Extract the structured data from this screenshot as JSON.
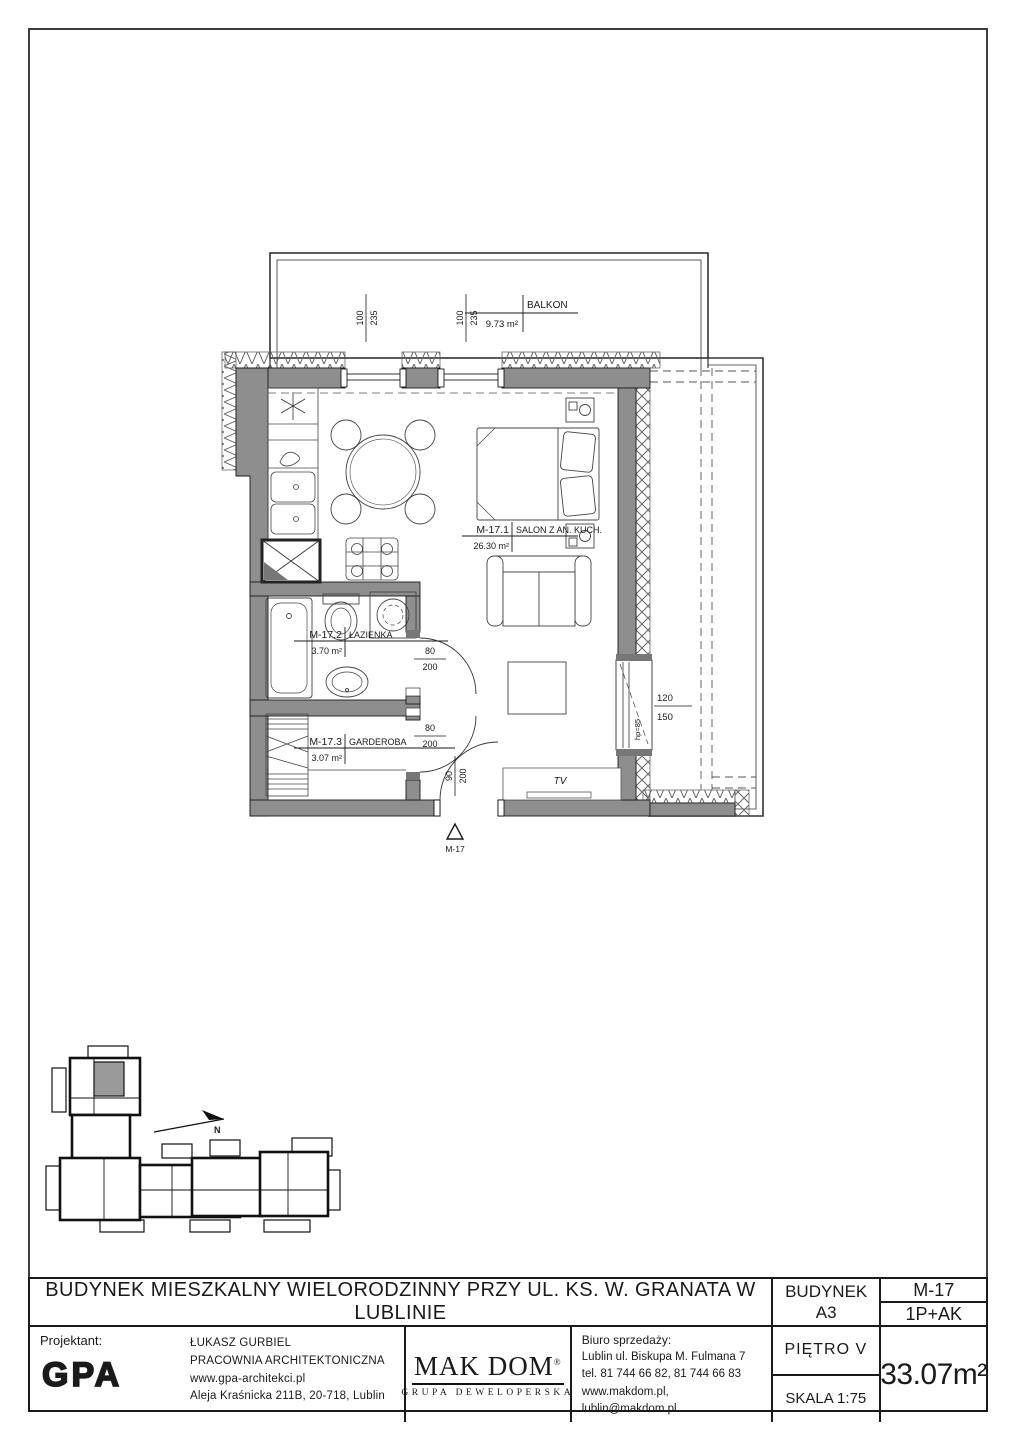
{
  "plan": {
    "balcony_label": "BALKON",
    "balcony_area": "9.73 m²",
    "rooms": [
      {
        "id": "M-17.1",
        "name": "SALON Z AN. KUCH.",
        "area": "26.30 m²"
      },
      {
        "id": "M-17.2",
        "name": "ŁAZIENKA",
        "area": "3.70 m²"
      },
      {
        "id": "M-17.3",
        "name": "GARDEROBA",
        "area": "3.07 m²"
      }
    ],
    "dims": {
      "balcony_door_left": {
        "w": "100",
        "h": "235"
      },
      "balcony_door_right": {
        "w": "100",
        "h": "235"
      },
      "bathroom_door": {
        "w": "80",
        "h": "200"
      },
      "wardrobe_door": {
        "w": "80",
        "h": "200"
      },
      "entrance_door": {
        "w": "90",
        "h": "200"
      },
      "window": {
        "w": "120",
        "h": "150"
      }
    },
    "window_sill_note": "hp=85",
    "tv_label": "TV",
    "section_marker": "M-17",
    "north_label": "N"
  },
  "keyplan": {
    "highlight_color": "#9a9a9a"
  },
  "titleblock": {
    "project_title": "BUDYNEK MIESZKALNY WIELORODZINNY PRZY UL. KS. W. GRANATA W LUBLINIE",
    "building_label": "BUDYNEK",
    "building_value": "A3",
    "unit_code": "M-17",
    "unit_type": "1P+AK",
    "floor": "PIĘTRO V",
    "scale": "SKALA 1:75",
    "total_area": "33.07m²",
    "designer": {
      "label": "Projektant:",
      "logo": "GPA",
      "name": "ŁUKASZ GURBIEL",
      "studio": "PRACOWNIA ARCHITEKTONICZNA",
      "website": "www.gpa-architekci.pl",
      "address": "Aleja Kraśnicka 211B, 20-718, Lublin"
    },
    "developer": {
      "brand": "MAK DOM",
      "registered": "®",
      "tagline": "GRUPA DEWELOPERSKA"
    },
    "sales_office": {
      "label": "Biuro sprzedaży:",
      "address": "Lublin ul. Biskupa M. Fulmana 7",
      "phones": "tel. 81 744 66 82, 81 744 66 83",
      "web": "www.makdom.pl, lublin@makdom.pl"
    }
  }
}
